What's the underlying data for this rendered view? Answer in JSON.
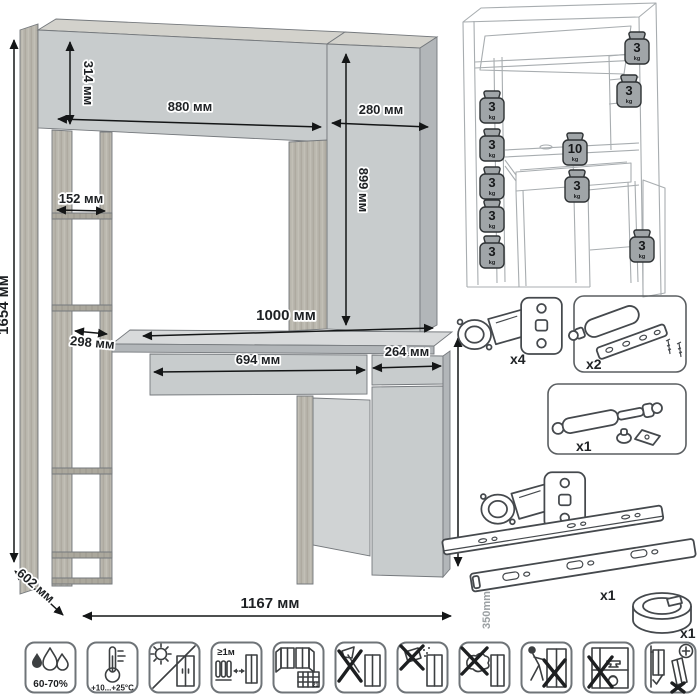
{
  "sheet": {
    "type": "furniture-assembly-dimension-sheet"
  },
  "dimensions": {
    "total_height": "1654 мм",
    "hutch_height": "314 мм",
    "hutch_width": "880 мм",
    "top_cabinet_width": "280 мм",
    "top_cabinet_height": "899 мм",
    "shelf_width": "152 мм",
    "shelf_depth": "298 мм",
    "desktop_width": "1000 мм",
    "drawer_width": "694 мм",
    "door_width": "264 мм",
    "desk_height": "746 мм",
    "depth": "602 мм",
    "total_width": "1167 мм"
  },
  "load_capacity": {
    "weights": [
      {
        "location": "hutch-top",
        "value": "3",
        "unit": "kg"
      },
      {
        "location": "right-shelf",
        "value": "3",
        "unit": "kg"
      },
      {
        "location": "left-shelf-1",
        "value": "3",
        "unit": "kg"
      },
      {
        "location": "left-shelf-2",
        "value": "3",
        "unit": "kg"
      },
      {
        "location": "desktop",
        "value": "10",
        "unit": "kg"
      },
      {
        "location": "drawer",
        "value": "3",
        "unit": "kg"
      },
      {
        "location": "left-shelf-3",
        "value": "3",
        "unit": "kg"
      },
      {
        "location": "left-shelf-4",
        "value": "3",
        "unit": "kg"
      },
      {
        "location": "left-shelf-5",
        "value": "3",
        "unit": "kg"
      },
      {
        "location": "base-cabinet",
        "value": "3",
        "unit": "kg"
      }
    ]
  },
  "hardware": {
    "items": [
      {
        "name": "hinge",
        "count": "x4"
      },
      {
        "name": "door-damper",
        "count": "x2"
      },
      {
        "name": "gas-lift",
        "count": "x1"
      },
      {
        "name": "hinge",
        "count": "x2"
      },
      {
        "name": "drawer-slides",
        "count": "x1",
        "length": "350mm"
      },
      {
        "name": "cable-grommet",
        "count": "x1"
      }
    ]
  },
  "care_icons": [
    {
      "name": "humidity-range",
      "label": "60-70%"
    },
    {
      "name": "temperature-range",
      "label": "+10...+25°C"
    },
    {
      "name": "no-direct-sunlight",
      "label": ""
    },
    {
      "name": "heat-source-distance",
      "label": "≥1м"
    },
    {
      "name": "ventilation",
      "label": "21"
    },
    {
      "name": "no-sharp-tools",
      "label": ""
    },
    {
      "name": "no-abrasive-cleaners",
      "label": ""
    },
    {
      "name": "no-wet-cloth",
      "label": ""
    },
    {
      "name": "no-dragging",
      "label": ""
    },
    {
      "name": "no-overloading",
      "label": ""
    },
    {
      "name": "wall-anchoring-required",
      "label": ""
    }
  ]
}
